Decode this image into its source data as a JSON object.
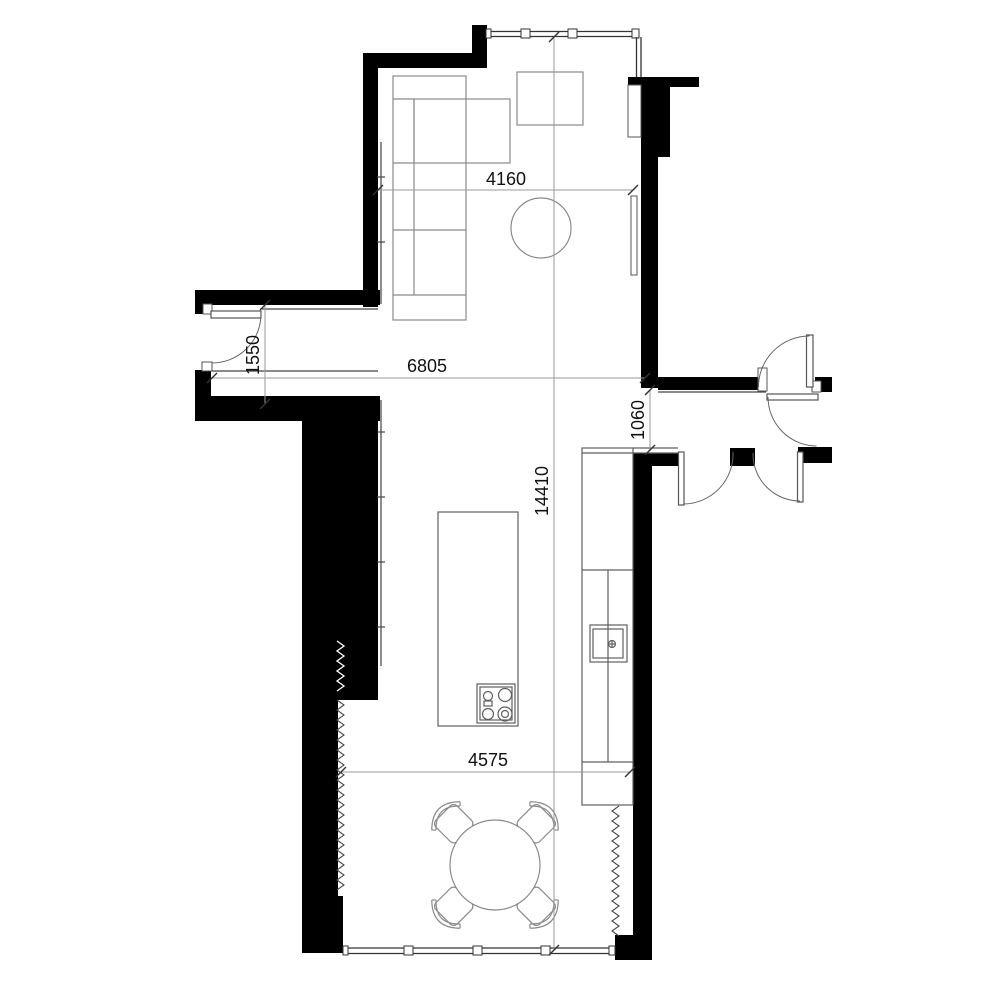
{
  "drawing": {
    "title": "apartment floor plan",
    "labels": {
      "living_width": "4160",
      "hall_length": "6805",
      "entry_opening": "1550",
      "corridor_width": "1060",
      "overall_height": "14410",
      "dining_width": "4575"
    },
    "colors": {
      "wall": "#000000",
      "detail_line": "#444444",
      "furniture_line": "#8a8a8a",
      "dimension_line": "#9a9a9a",
      "text": "#111111",
      "background": "#ffffff"
    },
    "elements": [
      "corner-sofa",
      "side-table",
      "coffee-table",
      "radiator",
      "wall-niche",
      "kitchen-island",
      "cooktop",
      "kitchen-counter",
      "sink",
      "dining-table",
      "dining-chair",
      "entry-door",
      "interior-door",
      "window",
      "insulation-hatch"
    ]
  }
}
